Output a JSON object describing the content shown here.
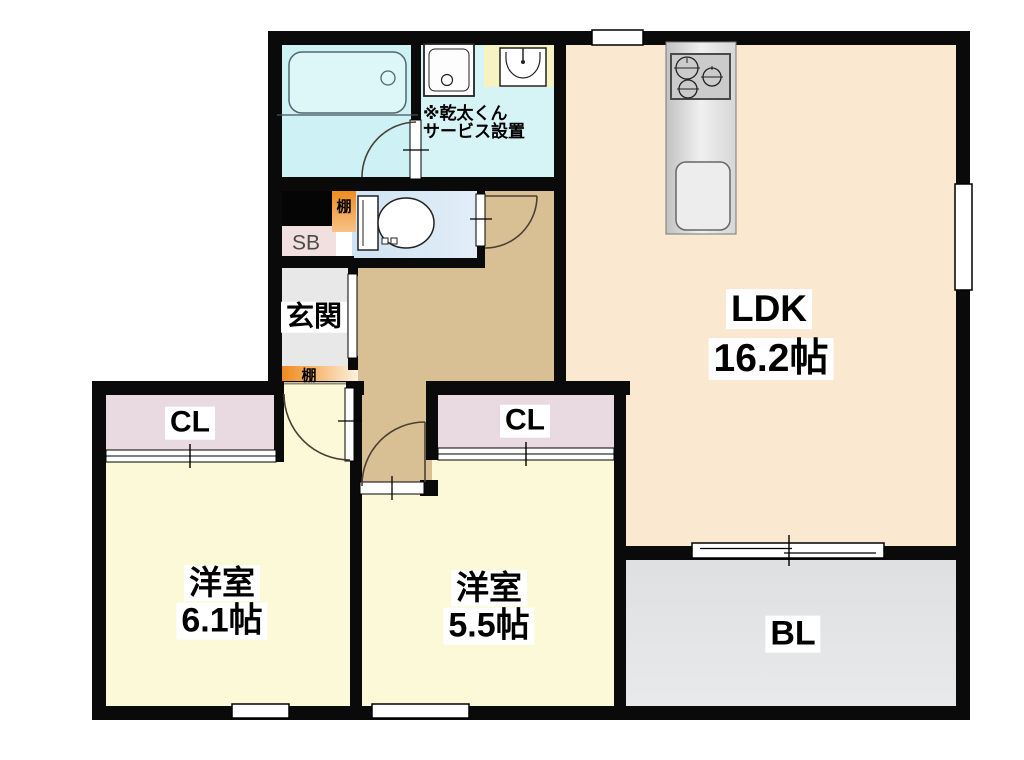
{
  "floorplan": {
    "rooms": {
      "ldk": {
        "label": "LDK",
        "size": "16.2帖"
      },
      "bedroom_left": {
        "label": "洋室",
        "size": "6.1帖"
      },
      "bedroom_center": {
        "label": "洋室",
        "size": "5.5帖"
      },
      "balcony": {
        "label": "BL"
      },
      "entrance": {
        "label": "玄関"
      },
      "closet_left": {
        "label": "CL"
      },
      "closet_center": {
        "label": "CL"
      },
      "shoe_box": {
        "label": "SB"
      },
      "shelf_by_toilet": {
        "label": "棚"
      },
      "shelf_by_entrance": {
        "label": "棚"
      }
    },
    "annotation": {
      "line1": "※乾太くん",
      "line2": "サービス設置"
    },
    "colors": {
      "wall": "#0a0a0a",
      "ldk_floor": "#fae8d0",
      "bedroom_floor": "#fbf9d8",
      "closet": "#e9d9e1",
      "bathroom": "#cdf1f4",
      "washroom": "#d6f3f5",
      "toilet_room": "#cfe3f3",
      "hallway": "#d8bf94",
      "entrance_floor": "#e8e8e8",
      "balcony": "#e2e3e5",
      "shelf_orange": "#f08010",
      "shoe_box_bg": "#f2dfdf",
      "vanity_counter": "#f6f2c4"
    }
  }
}
